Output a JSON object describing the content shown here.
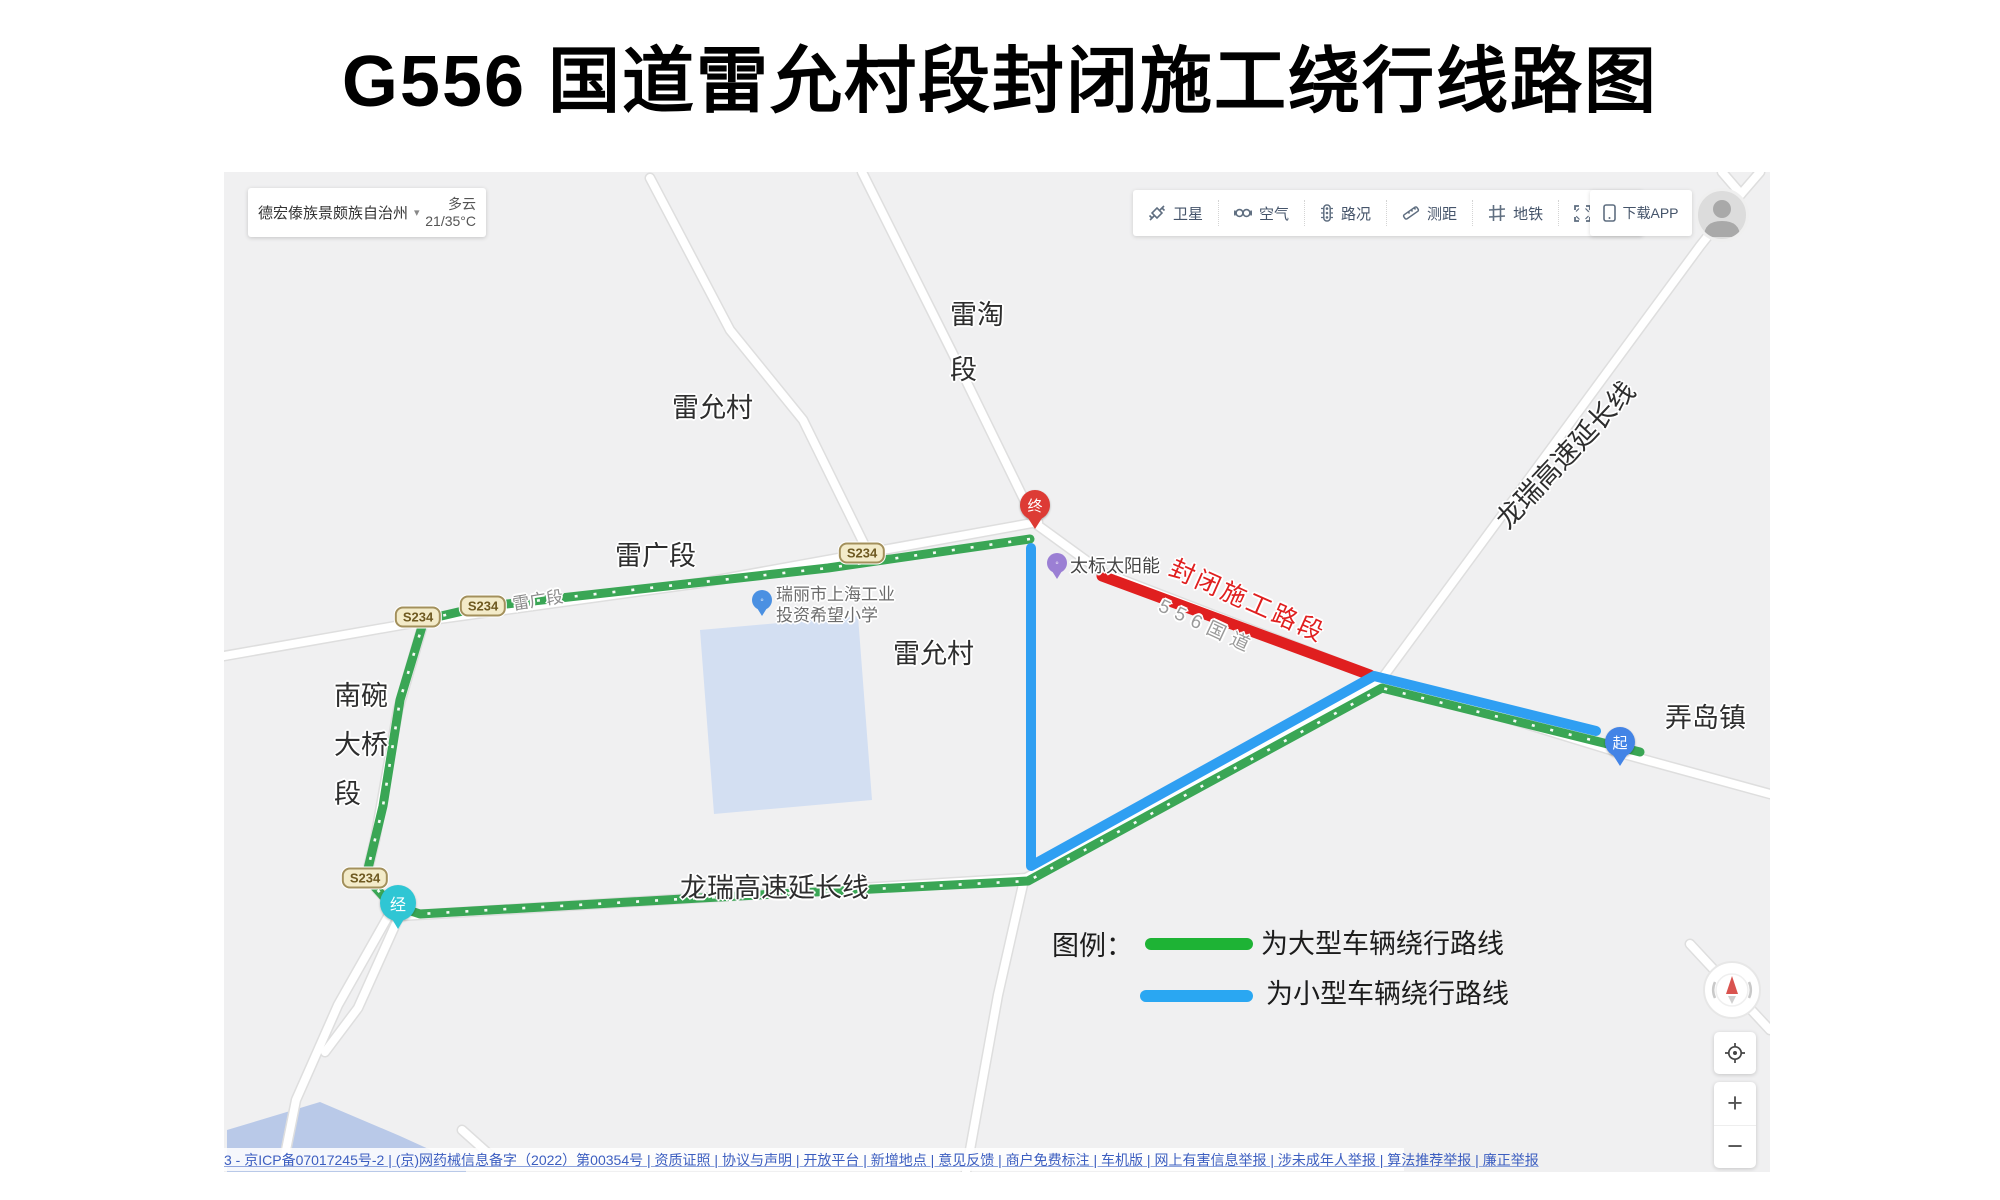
{
  "title": "G556 国道雷允村段封闭施工绕行线路图",
  "location_bar": {
    "region": "德宏傣族景颇族自治州",
    "caret": "▾",
    "weather": "多云",
    "temp": "21/35°C"
  },
  "toolbar": {
    "items": [
      {
        "label": "卫星",
        "icon": "satellite-icon"
      },
      {
        "label": "空气",
        "icon": "air-icon"
      },
      {
        "label": "路况",
        "icon": "traffic-icon"
      },
      {
        "label": "测距",
        "icon": "ruler-icon"
      },
      {
        "label": "地铁",
        "icon": "metro-icon"
      },
      {
        "label": "全屏",
        "icon": "fullscreen-icon"
      }
    ],
    "download_label": "下载APP"
  },
  "map": {
    "labels": {
      "leitao": [
        "雷淘",
        "段"
      ],
      "leiyuncun_nw": "雷允村",
      "leiguang_big": "雷广段",
      "leiguang_road": "雷广段",
      "leiyuncun_center": "雷允村",
      "nanwan": [
        "南碗",
        "大桥",
        "段"
      ],
      "longrui_south": "龙瑞高速延长线",
      "longrui_ne": "龙瑞高速延长线",
      "nongdao": "弄岛镇",
      "closed_section": "封闭施工路段",
      "g556_road": "556国道",
      "poi_solar": "太标太阳能",
      "poi_school": [
        "瑞丽市上海工业",
        "投资希望小学"
      ]
    },
    "badges": {
      "s234": "S234"
    },
    "markers": {
      "end": "终",
      "start": "起",
      "via": "经"
    },
    "colors": {
      "route_green": "#3aa655",
      "route_blue": "#2f9ff2",
      "closed_red": "#e01f1f",
      "water": "#b9c9e8"
    }
  },
  "legend": {
    "title": "图例：",
    "items": [
      {
        "color": "#1eb335",
        "label": "为大型车辆绕行路线"
      },
      {
        "color": "#2aa7f2",
        "label": "为小型车辆绕行路线"
      }
    ]
  },
  "controls": {
    "zoom_in": "+",
    "zoom_out": "−"
  },
  "footer": {
    "text": "3 - 京ICP备07017245号-2 | (京)网药械信息备字（2022）第00354号 | 资质证照 | 协议与声明 | 开放平台 | 新增地点 | 意见反馈 | 商户免费标注 | 车机版 | 网上有害信息举报 | 涉未成年人举报 | 算法推荐举报 | 廉正举报"
  }
}
